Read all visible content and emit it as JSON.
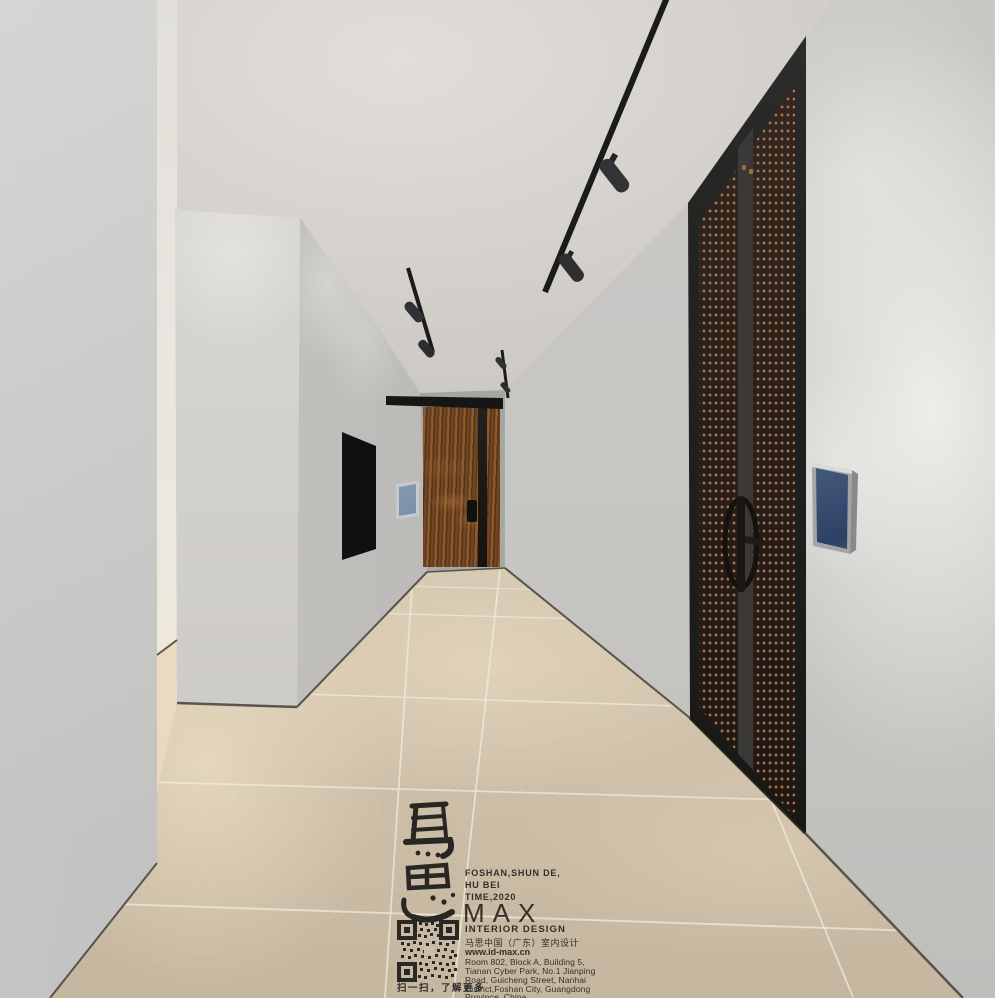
{
  "palette": {
    "ceiling": "#e1ded9",
    "ceiling-far": "#c6c3be",
    "wall-left": "#d2d2d0",
    "wall-left-dark": "#c1c0be",
    "column": "#dcdad6",
    "column-dark": "#c9c6c2",
    "sliver": "#eae7e1",
    "sliver-warm": "#e7d8be",
    "wall-recede": "#c9c8c5",
    "wall-recede-deep": "#9c9d9a",
    "far-wall": "#a7a7a4",
    "wall-right": "#c6c5c2",
    "floor": "#cec0a9",
    "floor-far": "#d8ccb6",
    "grout": "#f2ecdf",
    "baseboard-shadow": "#45403a",
    "tv": "#0c0c0e",
    "track": "#1b1b1b",
    "spot": "#333335",
    "door-frame": "#232322",
    "door-bronze": "#281f1a",
    "door-stud": "#7c5336",
    "wood": "#6f4524",
    "wood-dark": "#543315",
    "wood-light": "#8c5a2e",
    "art-navy": "#2c4166",
    "art-blue": "#7189a6",
    "art-light": "#e9eff3",
    "frame-gray": "#a3a4a5",
    "ink": "#21201e"
  },
  "watermark": {
    "calligraphy": "马思",
    "tagline_lines": [
      "FOSHAN,SHUN DE,",
      "HU BEI",
      "TIME,2020"
    ],
    "logo": "MAX",
    "subtitle": "INTERIOR DESIGN",
    "company_cn": "马思中国（广东）室内设计",
    "website": "www.id-max.cn",
    "address_lines": [
      "Room 802, Block A, Building 5,",
      "Tianan Cyber Park, No.1 Jianping",
      "Road, Guicheng Street, Nanhai",
      "District,Foshan City, Guangdong",
      "Province, China"
    ],
    "qr_caption": "扫一扫，了解更多"
  }
}
